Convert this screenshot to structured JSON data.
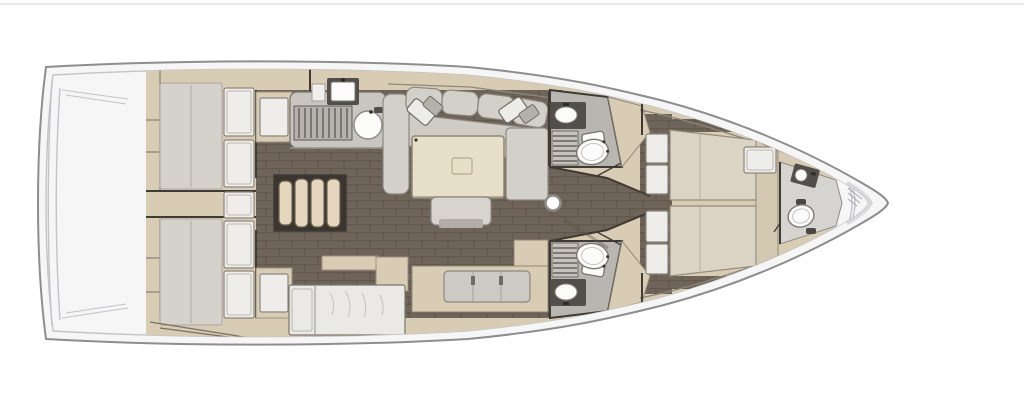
{
  "figure": {
    "kind": "sailboat-interior-floor-plan",
    "view": "top-down",
    "orientation": "bow-right-stern-left"
  },
  "colors": {
    "page_bg": "#ffffff",
    "top_border": "#e2e2e2",
    "hull_fill": "#f6f6f7",
    "hull_stroke": "#8e8e8e",
    "deck_line": "#c4c4c6",
    "bulwark": "#d9d9db",
    "cabinetry": "#d8cdb4",
    "cabinetry_line": "#9a9181",
    "wall": "#3f3a34",
    "floor": "#6f6459",
    "floor_line": "#5d5349",
    "mattress": "#d5d2cc",
    "mattress_line": "#aaa69f",
    "pillow": "#efede9",
    "pillow_line": "#8a8780",
    "sofa": "#d3d0ca",
    "sofa_line": "#8b8781",
    "seat": "#cfccc6",
    "table": "#e8dfc8",
    "table_line": "#8f8672",
    "counter": "#c9c6c1",
    "slat": "#54504b",
    "fixture_dark": "#524e49",
    "white_fixture": "#fbfbfa",
    "head_floor": "#b9b6b1",
    "grate": "#c5c2bd",
    "steps": "#e3d8be",
    "steps_line": "#6f6150",
    "lounge": "#ebe9e5",
    "fore_mattress": "#dbd4c4",
    "fore_headboard": "#d3c8b1",
    "shadow": "#5f564c"
  },
  "rooms": [
    {
      "id": "aft-cabin-port",
      "fixtures": [
        "double-berth",
        "pillows",
        "wardrobe-lockers"
      ]
    },
    {
      "id": "aft-cabin-starboard",
      "fixtures": [
        "double-berth",
        "pillows",
        "wardrobe-lockers"
      ]
    },
    {
      "id": "companionway",
      "fixtures": [
        "steps"
      ]
    },
    {
      "id": "galley",
      "fixtures": [
        "sink",
        "round-sink",
        "stove-grate",
        "cutting-board"
      ]
    },
    {
      "id": "saloon",
      "fixtures": [
        "c-sofa",
        "throw-pillows",
        "table",
        "stool-bench"
      ]
    },
    {
      "id": "head-port",
      "fixtures": [
        "toilet",
        "sink",
        "shower-grate"
      ]
    },
    {
      "id": "head-starboard",
      "fixtures": [
        "toilet",
        "sink",
        "shower-grate"
      ]
    },
    {
      "id": "corridor",
      "fixtures": [
        "mast-post"
      ]
    },
    {
      "id": "forward-cabin",
      "fixtures": [
        "island-berth",
        "foot-lockers",
        "vanity"
      ]
    },
    {
      "id": "forward-head",
      "fixtures": [
        "toilet",
        "sink"
      ]
    },
    {
      "id": "starboard-settee",
      "fixtures": [
        "l-settee-cushions",
        "lounge-seat",
        "side-cabinet"
      ]
    }
  ],
  "icons": [
    "toilet-icon",
    "sink-icon",
    "round-sink-icon",
    "stove-grate-icon",
    "shower-grate-icon",
    "companionway-steps-icon",
    "mast-post-icon",
    "table-icon",
    "berth-icon",
    "sofa-icon"
  ]
}
